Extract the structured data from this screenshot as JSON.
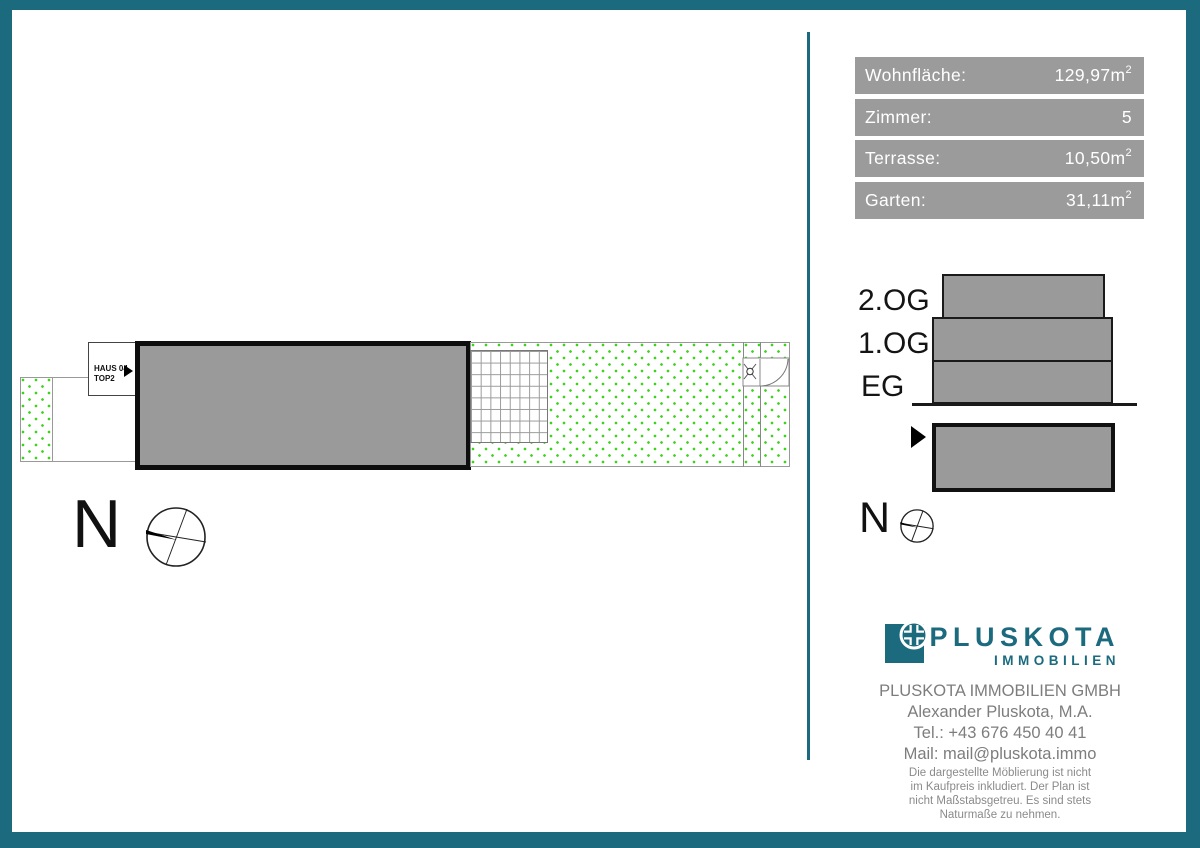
{
  "theme": {
    "teal": "#1b6a7e",
    "stat_gray": "#9b9b9b",
    "building_gray": "#9a9a9a",
    "dot_green": "#3cd31c",
    "text_gray": "#7d7d7d"
  },
  "plan": {
    "haus_label": {
      "line1": "HAUS 04",
      "line2": "TOP2"
    },
    "compass_letter": "N"
  },
  "stats": {
    "rows": [
      {
        "label": "Wohnfläche:",
        "value": "129,97m",
        "sup": "2"
      },
      {
        "label": "Zimmer:",
        "value": "5",
        "sup": ""
      },
      {
        "label": "Terrasse:",
        "value": "10,50m",
        "sup": "2"
      },
      {
        "label": "Garten:",
        "value": "31,11m",
        "sup": "2"
      }
    ]
  },
  "elevation": {
    "floors": [
      "2.OG",
      "1.OG",
      "EG"
    ],
    "compass_letter": "N"
  },
  "brand": {
    "name": "PLUSKOTA",
    "subtitle": "IMMOBILIEN"
  },
  "contact": {
    "company": "PLUSKOTA IMMOBILIEN GMBH",
    "person": "Alexander Pluskota, M.A.",
    "phone": "Tel.: +43 676 450 40 41",
    "mail": "Mail: mail@pluskota.immo"
  },
  "disclaimer": {
    "lines": [
      "Die dargestellte Möblierung ist nicht",
      "im Kaufpreis inkludiert. Der Plan ist",
      "nicht Maßstabsgetreu. Es sind stets",
      "Naturmaße zu nehmen."
    ]
  }
}
